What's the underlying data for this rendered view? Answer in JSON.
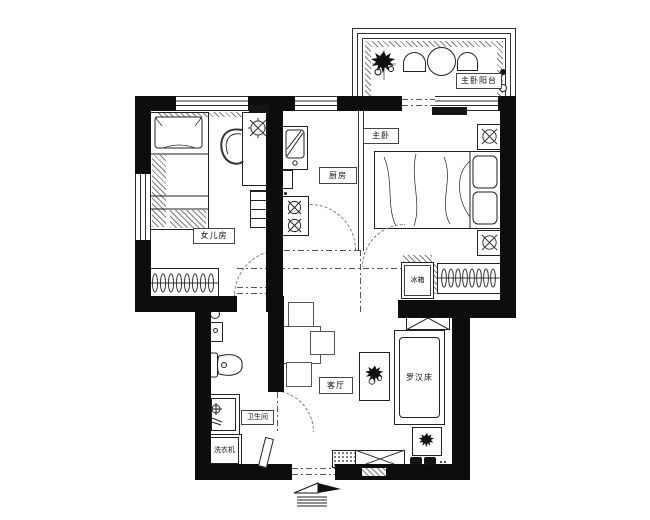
{
  "labels": {
    "daughter_room": "女儿房",
    "kitchen": "厨房",
    "master_bedroom": "主卧",
    "master_balcony": "主卧阳台",
    "living_room": "客厅",
    "bathroom": "卫生间",
    "fridge": "冰箱",
    "washing_machine": "洗衣机",
    "luohan_bed": "罗汉床"
  },
  "colors": {
    "wall": "#0d0d0d",
    "line": "#222222",
    "dash": "#555555",
    "background": "#ffffff"
  },
  "icons": {
    "plant": "scribble-star",
    "ceiling-lamp": "circle-cross",
    "hanger": "ellipse-row",
    "entry-arrow": "flag-with-steps",
    "burner": "circle-x"
  }
}
